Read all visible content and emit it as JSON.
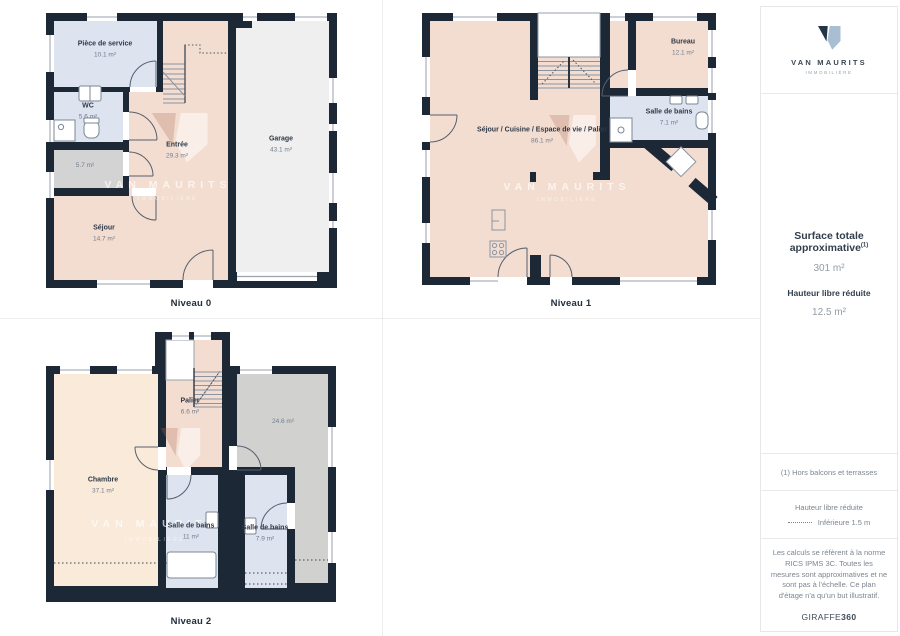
{
  "watermark": {
    "name": "VAN MAURITS",
    "sub": "IMMOBILIÈRE"
  },
  "colors": {
    "wall": "#1d2836",
    "peach": "#f3ddd1",
    "cream": "#faeada",
    "blue": "#dde3ef",
    "gray_small": "#d3d3d4",
    "gray_large": "#d1d1d0",
    "garage": "#efefef",
    "logo_dark": "#243447",
    "logo_light": "#a9bed3"
  },
  "plans": [
    {
      "caption": "Niveau 0",
      "rooms": [
        {
          "name": "Pièce de service",
          "area": "10.1 m²"
        },
        {
          "name": "WC",
          "area": "5.6 m²"
        },
        {
          "name": "",
          "area": "5.7 m²"
        },
        {
          "name": "Entrée",
          "area": "29.3 m²"
        },
        {
          "name": "Garage",
          "area": "43.1 m²"
        },
        {
          "name": "Séjour",
          "area": "14.7 m²"
        }
      ]
    },
    {
      "caption": "Niveau 1",
      "rooms": [
        {
          "name": "Séjour / Cuisine / Espace de vie / Palier",
          "area": "86.1 m²"
        },
        {
          "name": "Bureau",
          "area": "12.1 m²"
        },
        {
          "name": "Salle de bains",
          "area": "7.1 m²"
        }
      ]
    },
    {
      "caption": "Niveau 2",
      "rooms": [
        {
          "name": "Palier",
          "area": "6.6 m²"
        },
        {
          "name": "",
          "area": "24.6 m²"
        },
        {
          "name": "Chambre",
          "area": "37.1 m²"
        },
        {
          "name": "Salle de bains",
          "area": "11 m²"
        },
        {
          "name": "Salle de bains",
          "area": "7.9 m²"
        }
      ]
    }
  ],
  "sidebar": {
    "logo": {
      "name": "VAN MAURITS",
      "sub": "IMMOBILIÈRE"
    },
    "surface": {
      "title": "Surface totale approximative",
      "sup": "(1)",
      "value": "301 m²"
    },
    "hauteur": {
      "title": "Hauteur libre réduite",
      "value": "12.5 m²"
    },
    "note": "(1) Hors balcons et terrasses",
    "legend": {
      "title": "Hauteur libre réduite",
      "item": "Inférieure 1.5 m"
    },
    "disclaimer": "Les calculs se réfèrent à la norme RICS IPMS 3C. Toutes les mesures sont approximatives et ne sont pas à l'échelle. Ce plan d'étage n'a qu'un but illustratif.",
    "brand": {
      "name": "GIRAFFE",
      "suffix": "360"
    }
  }
}
